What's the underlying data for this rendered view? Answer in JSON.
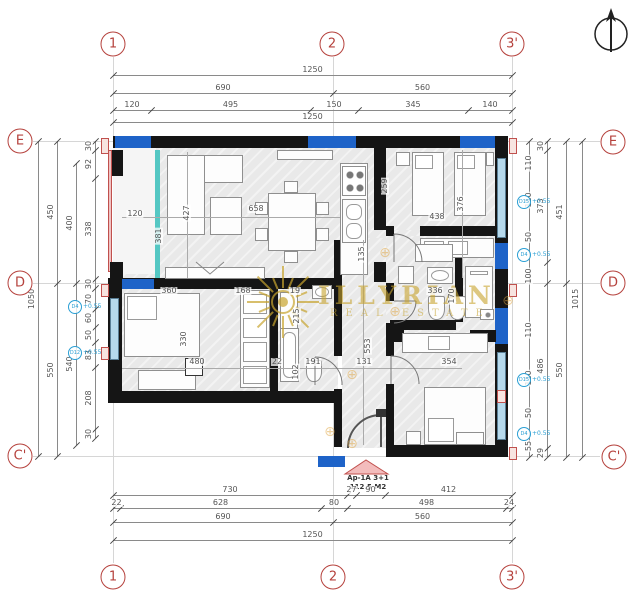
{
  "drawing": {
    "watermark_line1": "ILLYRIAN",
    "watermark_line2": "REAL ESTATE",
    "apartment_name": "Ap-1A 3+1",
    "apartment_area": "112.5 M2",
    "north_icon": "north-arrow"
  },
  "colors": {
    "wall": "#151515",
    "wall_blue": "#1e63c8",
    "window_lightblue": "#b6d9ec",
    "window_teal": "#54c7c3",
    "rail_pink": "#efc3c3",
    "grid_bubble_red": "#b5413c",
    "watermark_gold": "#c8a42e",
    "tag_cyan": "#2a9fd4"
  },
  "grid_bubbles": [
    {
      "label": "1",
      "x": 113,
      "y": 44
    },
    {
      "label": "2",
      "x": 332,
      "y": 44
    },
    {
      "label": "3'",
      "x": 512,
      "y": 44
    },
    {
      "label": "1",
      "x": 113,
      "y": 577
    },
    {
      "label": "2",
      "x": 333,
      "y": 577
    },
    {
      "label": "3'",
      "x": 512,
      "y": 577
    },
    {
      "label": "E",
      "x": 20,
      "y": 141
    },
    {
      "label": "D",
      "x": 20,
      "y": 283
    },
    {
      "label": "C'",
      "x": 20,
      "y": 456
    },
    {
      "label": "E",
      "x": 613,
      "y": 142
    },
    {
      "label": "D",
      "x": 613,
      "y": 283
    },
    {
      "label": "C'",
      "x": 614,
      "y": 457
    }
  ],
  "h_chains": [
    {
      "y": 75,
      "b": [
        113,
        512
      ],
      "l": [
        "1250"
      ]
    },
    {
      "y": 93,
      "b": [
        113,
        333,
        512
      ],
      "l": [
        "690",
        "560"
      ]
    },
    {
      "y": 110,
      "b": [
        113,
        151,
        310,
        358,
        468,
        512
      ],
      "l": [
        "120",
        "495",
        "150",
        "345",
        "140"
      ]
    },
    {
      "y": 122,
      "b": [
        113,
        512
      ],
      "l": [
        "1250"
      ]
    },
    {
      "y": 495,
      "b": [
        113,
        347,
        356,
        385,
        512
      ],
      "l": [
        "730",
        "27",
        "90",
        "412"
      ]
    },
    {
      "y": 508,
      "b": [
        113,
        120,
        321,
        347,
        506,
        512
      ],
      "l": [
        "22",
        "628",
        "80",
        "498",
        "24"
      ]
    },
    {
      "y": 522,
      "b": [
        113,
        333,
        512
      ],
      "l": [
        "690",
        "560"
      ]
    },
    {
      "y": 540,
      "b": [
        113,
        512
      ],
      "l": [
        "1250"
      ]
    }
  ],
  "v_chains": [
    {
      "x": 38,
      "b": [
        141,
        456
      ],
      "l": [
        "1050"
      ]
    },
    {
      "x": 57,
      "b": [
        141,
        283,
        456
      ],
      "l": [
        "450",
        "550"
      ]
    },
    {
      "x": 76,
      "b": [
        163,
        283,
        445
      ],
      "l": [
        "400",
        "540"
      ]
    },
    {
      "x": 95,
      "b": [
        141,
        150,
        178,
        279,
        288,
        309,
        327,
        342,
        367,
        429,
        438
      ],
      "l": [
        "30",
        "92",
        "338",
        "30",
        "70",
        "60",
        "50",
        "83",
        "208",
        "30"
      ]
    },
    {
      "x": 582,
      "b": [
        141,
        457
      ],
      "l": [
        "1015"
      ]
    },
    {
      "x": 566,
      "b": [
        141,
        283,
        457
      ],
      "l": [
        "451",
        "550"
      ]
    },
    {
      "x": 547,
      "b": [
        141,
        150,
        262,
        283,
        448,
        457
      ],
      "l": [
        "30",
        "373",
        "",
        "486",
        "29"
      ]
    },
    {
      "x": 529,
      "b": [
        141,
        457
      ],
      "l": []
    }
  ],
  "free_labels": [
    {
      "t": "110",
      "x": 529,
      "y": 163,
      "r": 1
    },
    {
      "t": "110",
      "x": 529,
      "y": 200,
      "r": 1
    },
    {
      "t": "50",
      "x": 529,
      "y": 237,
      "r": 1
    },
    {
      "t": "100",
      "x": 529,
      "y": 276,
      "r": 1
    },
    {
      "t": "110",
      "x": 529,
      "y": 330,
      "r": 1
    },
    {
      "t": "110",
      "x": 529,
      "y": 378,
      "r": 1
    },
    {
      "t": "50",
      "x": 529,
      "y": 413,
      "r": 1
    },
    {
      "t": "55",
      "x": 529,
      "y": 446,
      "r": 1
    },
    {
      "t": "120",
      "x": 135,
      "y": 218
    },
    {
      "t": "381",
      "x": 159,
      "y": 236,
      "r": 1
    },
    {
      "t": "427",
      "x": 187,
      "y": 213,
      "r": 1
    },
    {
      "t": "658",
      "x": 256,
      "y": 213
    },
    {
      "t": "259",
      "x": 385,
      "y": 186,
      "r": 1
    },
    {
      "t": "376",
      "x": 461,
      "y": 204,
      "r": 1
    },
    {
      "t": "438",
      "x": 437,
      "y": 221
    },
    {
      "t": "135",
      "x": 362,
      "y": 254,
      "r": 1
    },
    {
      "t": "553",
      "x": 368,
      "y": 346,
      "r": 1
    },
    {
      "t": "336",
      "x": 435,
      "y": 295
    },
    {
      "t": "170",
      "x": 452,
      "y": 296,
      "r": 1
    },
    {
      "t": "360",
      "x": 169,
      "y": 295
    },
    {
      "t": "168",
      "x": 243,
      "y": 295
    },
    {
      "t": "19",
      "x": 295,
      "y": 295
    },
    {
      "t": "330",
      "x": 184,
      "y": 339,
      "r": 1
    },
    {
      "t": "480",
      "x": 197,
      "y": 366
    },
    {
      "t": "22",
      "x": 277,
      "y": 366
    },
    {
      "t": "102",
      "x": 296,
      "y": 372,
      "r": 1
    },
    {
      "t": "191",
      "x": 313,
      "y": 366
    },
    {
      "t": "131",
      "x": 364,
      "y": 366
    },
    {
      "t": "354",
      "x": 449,
      "y": 366
    },
    {
      "t": "215",
      "x": 297,
      "y": 316,
      "r": 1
    }
  ],
  "window_tags": [
    {
      "label": "D4",
      "note": "+0.55",
      "x": 75,
      "y": 307
    },
    {
      "label": "D12",
      "note": "+0.55",
      "x": 75,
      "y": 353
    },
    {
      "label": "D15",
      "note": "+0.55",
      "x": 524,
      "y": 202
    },
    {
      "label": "D4",
      "note": "+0.55",
      "x": 524,
      "y": 255
    },
    {
      "label": "D15",
      "note": "+0.55",
      "x": 524,
      "y": 380
    },
    {
      "label": "D4",
      "note": "+0.55",
      "x": 524,
      "y": 434
    }
  ],
  "wm_crosses": [
    {
      "x": 385,
      "y": 253
    },
    {
      "x": 395,
      "y": 312
    },
    {
      "x": 352,
      "y": 375
    },
    {
      "x": 330,
      "y": 432
    },
    {
      "x": 352,
      "y": 444
    },
    {
      "x": 508,
      "y": 301
    }
  ]
}
